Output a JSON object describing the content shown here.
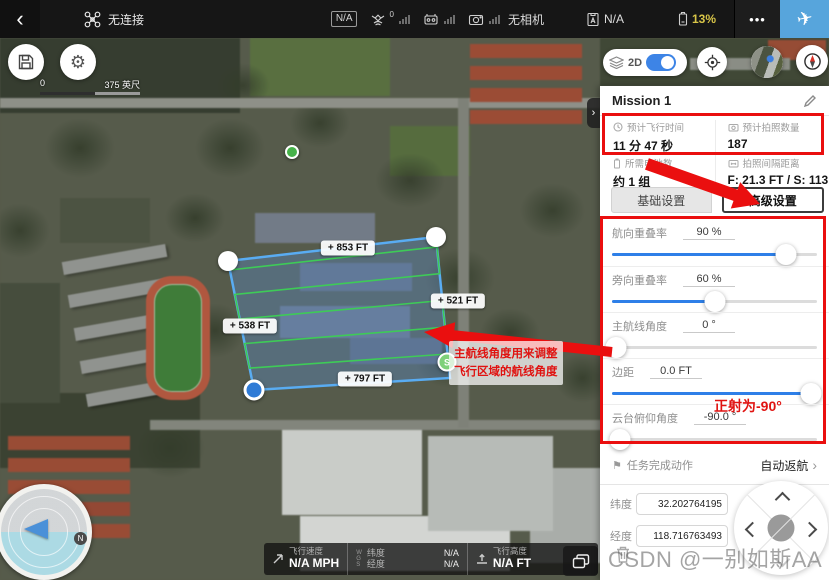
{
  "topbar": {
    "connection_status": "无连接",
    "link_na": "N/A",
    "gps_count": "0",
    "camera_status": "无相机",
    "flight_mode": "N/A",
    "battery": "13%"
  },
  "icons": {
    "back": "‹",
    "more": "•••",
    "takeoff": "✈",
    "gear": "⚙",
    "flag": "⚑",
    "chevron_right": "›"
  },
  "map_controls": {
    "mode_label": "2D",
    "scale_start": "0",
    "scale_end": "375 英尺"
  },
  "map": {
    "edge_labels": [
      "+ 853 FT",
      "+ 521 FT",
      "+ 538 FT",
      "+ 797 FT"
    ],
    "start_marker": "S"
  },
  "telemetry": {
    "speed_label": "飞行速度",
    "speed_value": "N/A MPH",
    "wgs_letters": [
      "W",
      "G",
      "S"
    ],
    "lat_label": "纬度",
    "lat_value": "N/A",
    "lng_label": "经度",
    "lng_value": "N/A",
    "alt_label": "飞行高度",
    "alt_value": "N/A FT"
  },
  "panel": {
    "title": "Mission 1",
    "stats": [
      {
        "label": "预计飞行时间",
        "value": "11 分 47 秒"
      },
      {
        "label": "预计拍照数量",
        "value": "187"
      },
      {
        "label": "所需电池数",
        "value": "约 1 组"
      },
      {
        "label": "拍照间隔距离",
        "value": "F: 21.3 FT / S: 113.6 FT"
      }
    ],
    "tab_basic": "基础设置",
    "tab_advanced": "高级设置",
    "sliders": [
      {
        "label": "航向重叠率",
        "value": "90 %",
        "percent": 85
      },
      {
        "label": "旁向重叠率",
        "value": "60 %",
        "percent": 50
      },
      {
        "label": "主航线角度",
        "value": "0 °",
        "percent": 2
      },
      {
        "label": "边距",
        "value": "0.0 FT",
        "percent": 97
      },
      {
        "label": "云台俯仰角度",
        "value": "-90.0 °",
        "percent": 4
      }
    ],
    "finish_label": "任务完成动作",
    "finish_value": "自动返航",
    "lat_label": "纬度",
    "lat_value": "32.202764195",
    "lng_label": "经度",
    "lng_value": "118.716763493"
  },
  "annotations": {
    "map_note_line1": "主航线角度用来调整",
    "map_note_line2": "飞行区域的航线角度",
    "gimbal_note": "正射为-90°"
  },
  "watermark": "CSDN @一别如斯AA",
  "colors": {
    "annotation_red": "#ea0f0f",
    "slider_blue": "#2e7fe8",
    "takeoff_blue": "#57a5dc",
    "battery_yellow": "#d8c548",
    "polygon_stroke": "#59acf2",
    "route_green": "#3ecb57"
  }
}
